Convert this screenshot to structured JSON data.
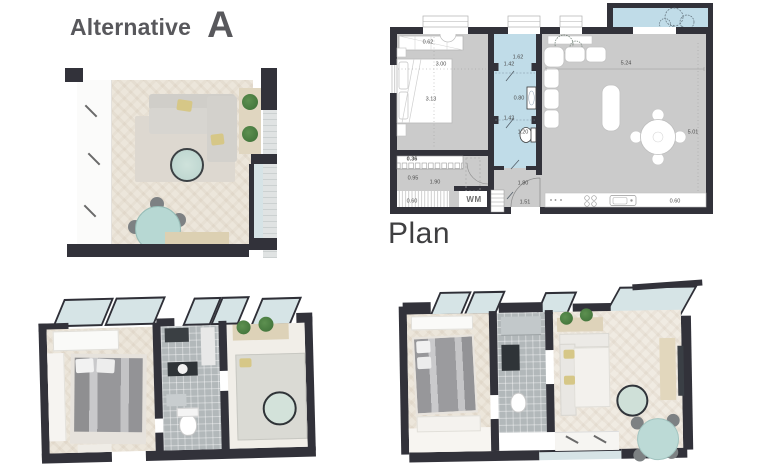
{
  "title": {
    "main": "Alternative",
    "variant": "A"
  },
  "plan": {
    "label": "Plan",
    "dims": {
      "closet_depth": "0.62",
      "bedroom_width": "3.00",
      "bedroom_length": "3.13",
      "bath_entry_width": "1.62",
      "bath_width": "1.42",
      "bath_mid_width": "0.80",
      "wc_width": "1.42",
      "wc_length": "1.20",
      "living_width": "5.24",
      "living_length": "5.01",
      "hall_wardrobe_depth": "0.36",
      "hall_width": "0.95",
      "hall_length": "1.90",
      "hall_window": "0.60",
      "corridor_width": "1.80",
      "corridor_length": "1.51",
      "kitchen_counter": "0.60",
      "washing_machine": "WM"
    }
  },
  "colors": {
    "wall": "#32323a",
    "plan_floor": "#cbcbcb",
    "wet_area_blue": "#c0dce8",
    "accent_teal": "#b7d8d3",
    "wood_beige": "#ddd1b4",
    "render_floor": "#ece6db",
    "title_text": "#58585c",
    "dim_text": "#4b4b4b"
  },
  "icons": {
    "balcony_tree": "tree-sketch",
    "living_plant": "plant-sketch",
    "shelf_plants": "potted-plant"
  }
}
